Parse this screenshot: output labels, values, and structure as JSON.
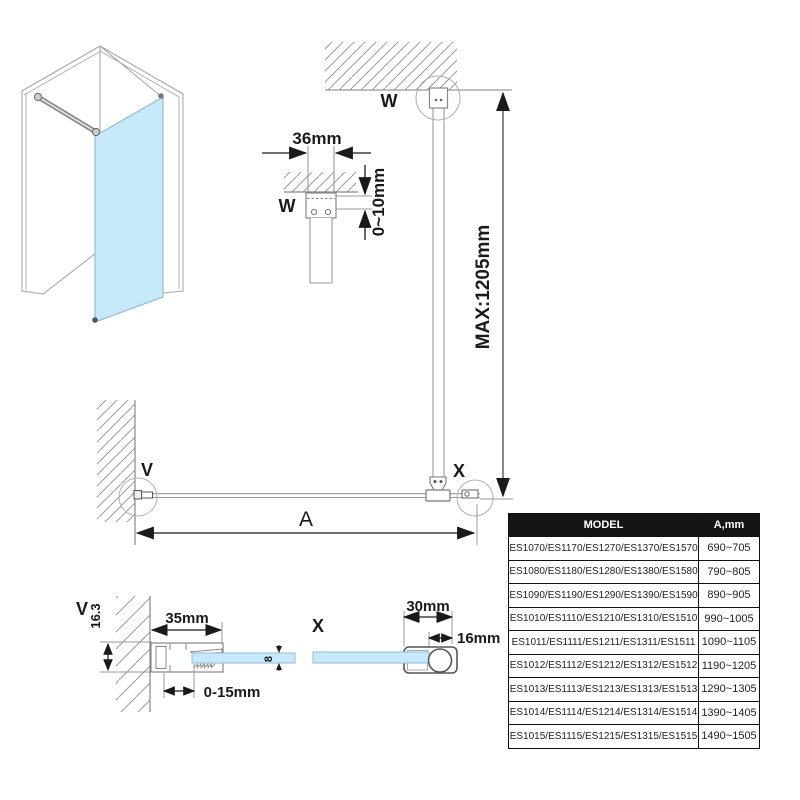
{
  "colors": {
    "glass": "#c8e9fb",
    "glass_edge": "#90bdd4",
    "line": "#999999",
    "dark": "#1a1a1a",
    "table_header_bg": "#151515"
  },
  "iso_view": {
    "description": "isometric walk-in shower glass panel with support bar"
  },
  "labels": {
    "w_plan": "W",
    "w_detail": "W",
    "v_plan": "V",
    "v_detail": "V",
    "x_plan": "X",
    "x_detail": "X"
  },
  "dims": {
    "bar_width": "36mm",
    "wall_gap": "0~10mm",
    "bar_max": "MAX:1205mm",
    "panel_width": "A",
    "profile_depth": "16.3",
    "profile_width": "35mm",
    "glass_thickness": "8",
    "profile_adjust": "0-15mm",
    "clamp_width": "30mm",
    "clamp_bar": "16mm"
  },
  "table": {
    "headers": {
      "model": "MODEL",
      "a": "A,mm"
    },
    "rows": [
      {
        "model": "ES1070/ES1170/ES1270/ES1370/ES1570",
        "a": "690~705"
      },
      {
        "model": "ES1080/ES1180/ES1280/ES1380/ES1580",
        "a": "790~805"
      },
      {
        "model": "ES1090/ES1190/ES1290/ES1390/ES1590",
        "a": "890~905"
      },
      {
        "model": "ES1010/ES1110/ES1210/ES1310/ES1510",
        "a": "990~1005"
      },
      {
        "model": "ES1011/ES1111/ES1211/ES1311/ES1511",
        "a": "1090~1105"
      },
      {
        "model": "ES1012/ES1112/ES1212/ES1312/ES1512",
        "a": "1190~1205"
      },
      {
        "model": "ES1013/ES1113/ES1213/ES1313/ES1513",
        "a": "1290~1305"
      },
      {
        "model": "ES1014/ES1114/ES1214/ES1314/ES1514",
        "a": "1390~1405"
      },
      {
        "model": "ES1015/ES1115/ES1215/ES1315/ES1515",
        "a": "1490~1505"
      }
    ]
  }
}
